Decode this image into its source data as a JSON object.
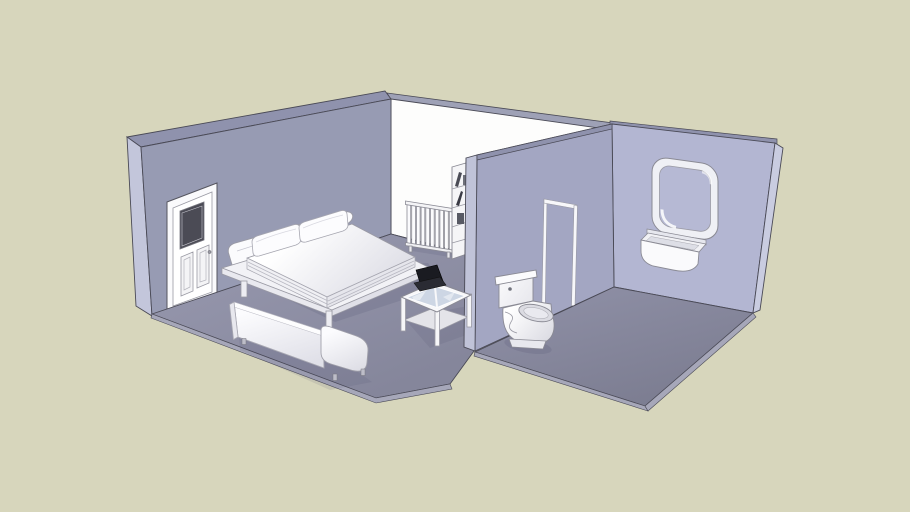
{
  "scene": {
    "title": "3D interior model - bedroom and bathroom (SketchUp-style shaded render)",
    "view": "perspective isometric from upper front-left",
    "rooms": [
      {
        "name": "bedroom",
        "items": [
          "paneled door with dark window",
          "double bed with curved headboard and two pillows",
          "white sofa",
          "glass coffee table",
          "black laptop on coffee table",
          "column radiator",
          "bookshelf with books"
        ]
      },
      {
        "name": "bathroom",
        "items": [
          "open doorway outline",
          "toilet",
          "wall-mounted sink with two taps",
          "rounded-square mirror"
        ]
      }
    ]
  },
  "colors": {
    "background": "#D7D6BC",
    "bedroom_wall": "#979BB3",
    "wall_edge": "#C3C6DB",
    "wall_top": "#8F92AD",
    "back_wall": "#FDFDFC",
    "back_wall_top": "#9EA1B6",
    "divider_wall": "#A3A6C2",
    "divider_wall_edge": "#C0C3D8",
    "bathroom_wall": "#B3B6D2",
    "bathroom_wall_edge": "#C9CCE0",
    "bedroom_floor": "#8D8EA4",
    "bathroom_floor": "#84859B",
    "floor_edge": "#A6A7B9",
    "outline": "#4A4A56",
    "furniture_white": "#F8F8FA",
    "glass": "#C9D3E2",
    "mirror_glass": "#B6B9D4",
    "laptop": "#1A1B21",
    "door_window": "#4B4B55"
  }
}
